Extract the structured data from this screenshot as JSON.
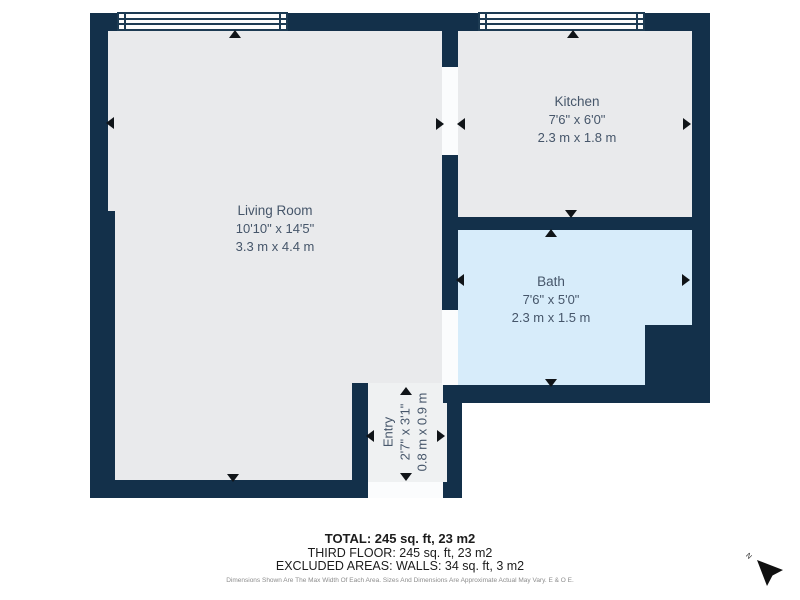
{
  "floorplan": {
    "rooms": [
      {
        "name": "Living Room",
        "imperial": "10'10\" x 14'5\"",
        "metric": "3.3 m x 4.4 m"
      },
      {
        "name": "Kitchen",
        "imperial": "7'6\" x 6'0\"",
        "metric": "2.3 m x 1.8 m"
      },
      {
        "name": "Bath",
        "imperial": "7'6\" x 5'0\"",
        "metric": "2.3 m x 1.5 m"
      },
      {
        "name": "Entry",
        "imperial": "2'7\" x 3'1\"",
        "metric": "0.8 m x 0.9 m"
      }
    ],
    "compass": {
      "label": "N"
    },
    "summary": {
      "total": "TOTAL: 245 sq. ft, 23 m2",
      "floor": "THIRD FLOOR: 245 sq. ft, 23 m2",
      "excluded": "EXCLUDED AREAS: WALLS: 34 sq. ft, 3 m2",
      "disclaimer": "Dimensions Shown Are The Max Width Of Each Area. Sizes And Dimensions Are Approximate Actual May Vary. E & O E."
    },
    "colors": {
      "wall": "#13304a",
      "floor": "#e9eaec",
      "bath-floor": "#d7ecfa",
      "entry-floor": "#eff1f2",
      "opening": "#fbfcfd",
      "window-line": "#1d3b53",
      "label-text": "#46566a",
      "arrow": "#101418",
      "summary-text": "#1c1c1c",
      "disclaimer-text": "#8d8d8d"
    }
  }
}
